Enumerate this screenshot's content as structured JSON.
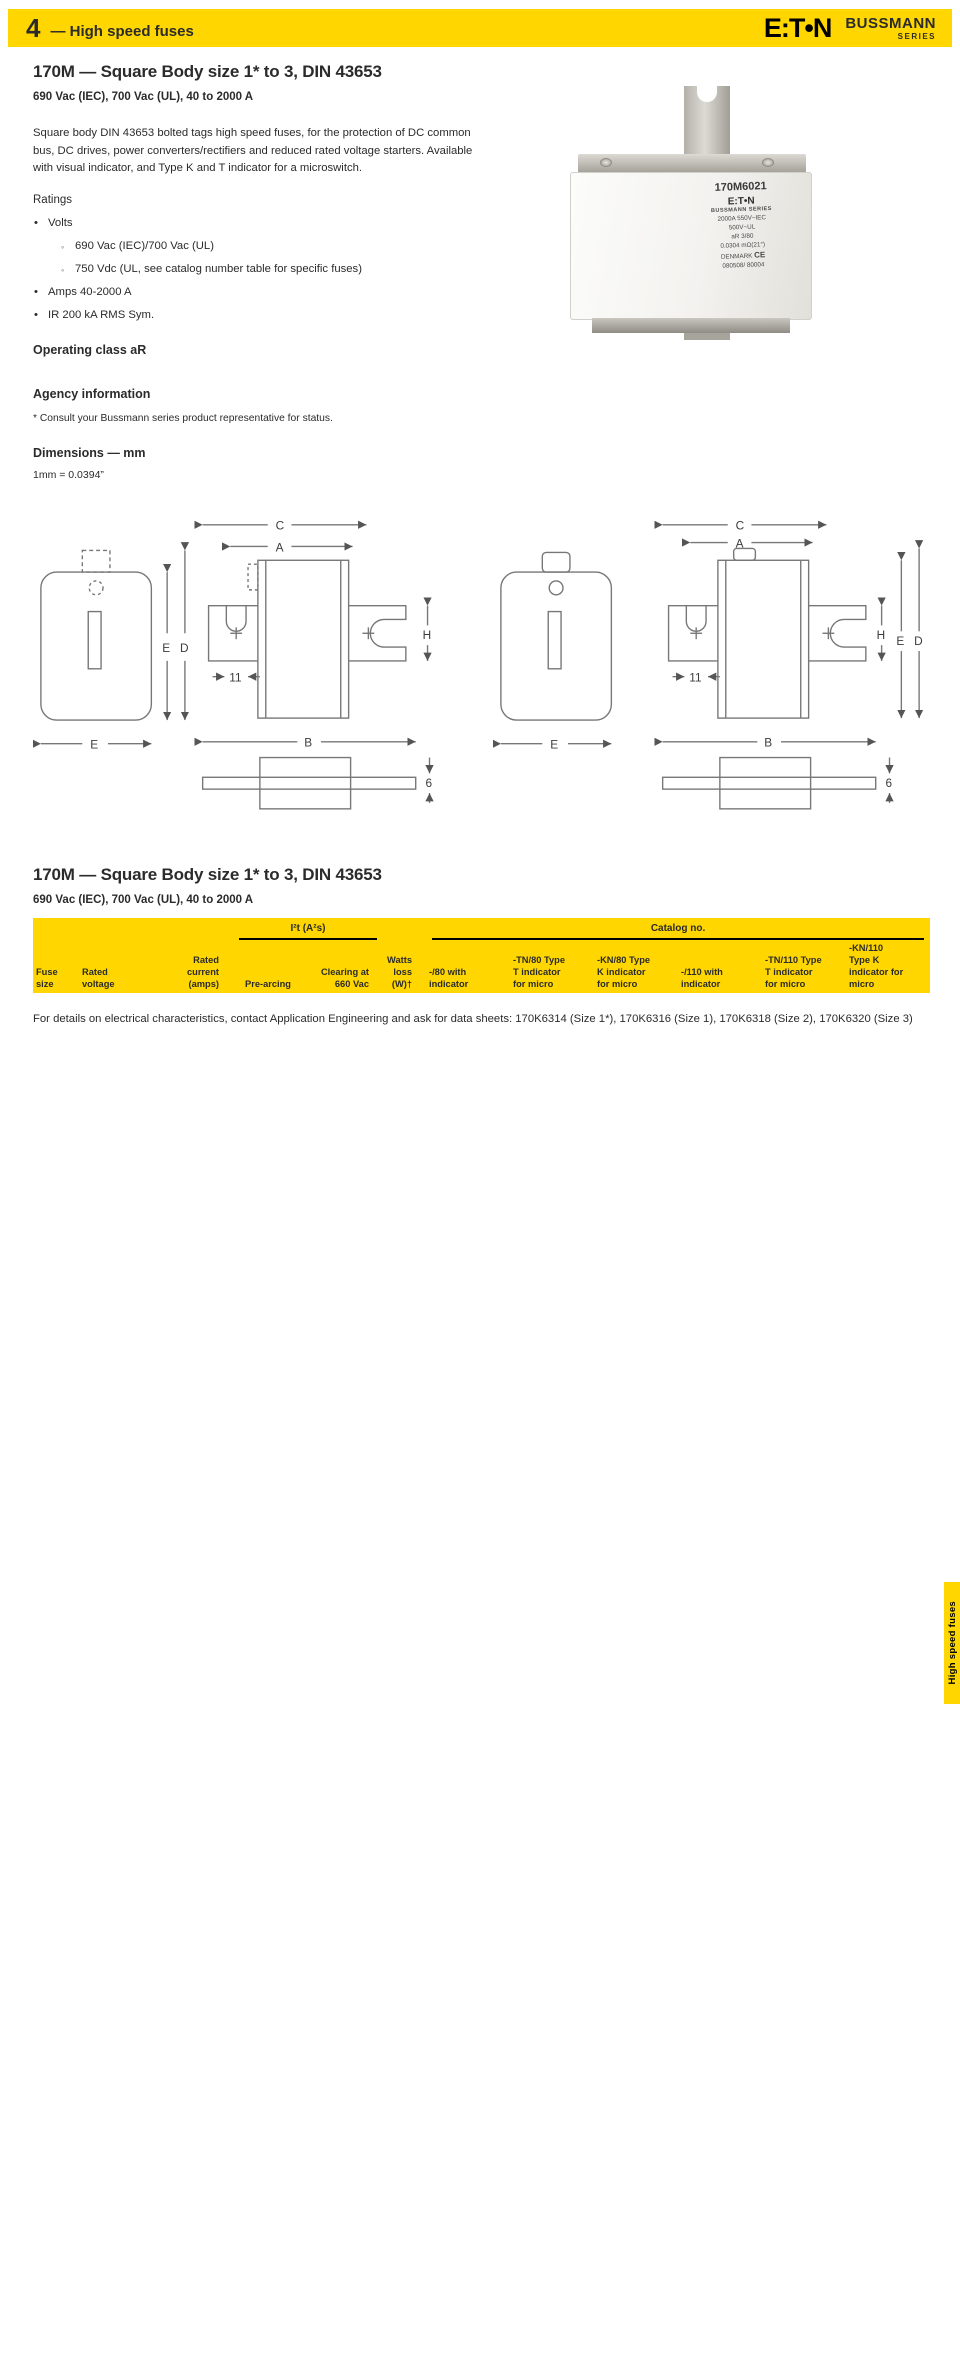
{
  "header": {
    "chapter": "4",
    "title": "High speed fuses",
    "logo_text": "E:T•N",
    "brand": "BUSSMANN",
    "brand_sub": "SERIES"
  },
  "section1": {
    "title": "170M — Square Body size 1* to 3, DIN 43653",
    "subtitle": "690 Vac (IEC), 700 Vac (UL), 40 to 2000 A",
    "description": "Square body DIN 43653 bolted tags high speed fuses, for the protection of DC common bus, DC drives, power converters/rectifiers and reduced rated voltage starters. Available with visual indicator, and Type K and T indicator for a microswitch.",
    "ratings_label": "Ratings",
    "ratings_items": [
      {
        "text": "Volts",
        "sub": [
          "690 Vac (IEC)/700 Vac (UL)",
          "750 Vdc (UL, see catalog number table for specific fuses)"
        ]
      },
      {
        "text": "Amps 40-2000 A"
      },
      {
        "text": "IR 200 kA RMS Sym."
      }
    ],
    "operating_class": "Operating class aR",
    "agency_title": "Agency information",
    "agency_items": [
      "Designed and tested to IEC 60269 Part 4",
      "UL Recognized, JFHR2*, E125085",
      "CSA Class 53787, File 1422-30*",
      "CCC except where noted",
      "CE"
    ],
    "agency_footnote": "*  Consult your Bussmann series product representative for status.",
    "dimensions_title": "Dimensions — mm",
    "dimensions_note": "1mm = 0.0394”"
  },
  "photo": {
    "part_number": "170M6021",
    "brand": "E:T•N",
    "series": "BUSSMANN SERIES",
    "line1": "2000A  550V~IEC",
    "line2": "500V~UL",
    "line3": "aR    3/80",
    "line4": "0.0304  mΩ(21°)",
    "line5": "DENMARK",
    "ce": "CE",
    "line6": "080508/ 80004"
  },
  "diagrams": {
    "labels": {
      "C": "C",
      "A": "A",
      "B": "B",
      "D": "D",
      "E": "E",
      "H": "H",
      "n11": "11",
      "n6": "6"
    }
  },
  "dim_left": {
    "title": "Type -/80, -TN/80, -/110, -TN/110",
    "headers": [
      "Size",
      "A",
      "B",
      "B¹",
      "C",
      "C¹",
      "D²",
      "E",
      "H"
    ],
    "rows": [
      [
        "1*",
        "50",
        "104",
        "134",
        "78",
        "108",
        "58",
        "45",
        "22"
      ],
      [
        "1",
        "50",
        "108",
        "138",
        "78",
        "108",
        "66",
        "53",
        "25"
      ],
      [
        "2",
        "50",
        "108",
        "138",
        "78",
        "108",
        "75",
        "61",
        "25"
      ],
      [
        "3",
        "51",
        "109",
        "139",
        "78",
        "108",
        "90",
        "76",
        "30"
      ]
    ],
    "footnotes": [
      "1  Valid for fuse Types -/110 and -TN/110.",
      "2  Valid for fuse Types -TN/80 and -TN/110."
    ]
  },
  "dim_right": {
    "title": "Type -KN/80, -KN/110",
    "headers": [
      "Size",
      "A",
      "B",
      "B³",
      "C",
      "C³",
      "D",
      "E",
      "H"
    ],
    "rows": [
      [
        "1*",
        "50",
        "104",
        "134",
        "78",
        "108",
        "59",
        "45",
        "22"
      ],
      [
        "1",
        "50",
        "108",
        "138",
        "78",
        "108",
        "69",
        "53",
        "25"
      ],
      [
        "2",
        "50",
        "108",
        "138",
        "78",
        "108",
        "77",
        "61",
        "25"
      ],
      [
        "3",
        "51",
        "109",
        "139",
        "78",
        "108",
        "92",
        "76",
        "30"
      ]
    ],
    "footnotes": [
      "3  Valid for fuse Type -KN/110."
    ]
  },
  "section2": {
    "title": "170M — Square Body size 1* to 3, DIN 43653",
    "subtitle": "690 Vac (IEC), 700 Vac (UL), 40 to 2000 A"
  },
  "catalog": {
    "group_i2t": "I²t (A²s)",
    "group_catalog": "Catalog no.",
    "col_headers": [
      "Fuse\nsize",
      "Rated\nvoltage",
      "Rated\ncurrent\n(amps)",
      "Pre-arcing",
      "Clearing at\n660 Vac",
      "Watts\nloss\n(W)†",
      "-/80 with\nindicator",
      "-TN/80 Type\nT indicator\nfor micro",
      "-KN/80 Type\nK indicator\nfor micro",
      "-/110 with\nindicator",
      "-TN/110 Type\nT indicator\nfor micro",
      "-KN/110\nType K\nindicator for\nmicro"
    ],
    "groups": [
      {
        "size": "1*",
        "voltages": [
          "690 Vac (IEC)",
          "700 Vac (UL)"
        ],
        "rows": [
          [
            "40",
            "40",
            "270",
            "9",
            "170M3008",
            "170M3058",
            "170M3108",
            "170M3158",
            "170M3208",
            "170M3258"
          ],
          [
            "50",
            "77",
            "515",
            "11",
            "170M3009",
            "170M3059",
            "170M3109",
            "170M3159",
            "170M3209",
            "170M3259"
          ],
          [
            "63",
            "115",
            "770",
            "14",
            "170M3010",
            "170M3060",
            "170M3110",
            "170M3160",
            "170M3210",
            "170M3260"
          ],
          [
            "80",
            "185",
            "1250",
            "18",
            "170M3011",
            "170M3061",
            "170M3111",
            "170M3161",
            "170M3211",
            "170M3261"
          ],
          [
            "100",
            "360",
            "2450",
            "21",
            "170M3012",
            "170M3062",
            "170M3112",
            "170M3162",
            "170M3212",
            "170M3262"
          ],
          [
            "125",
            "550",
            "3700",
            "26",
            "170M3013",
            "170M3063",
            "170M3113",
            "170M3163",
            "170M3213",
            "170M3263"
          ],
          [
            "160",
            "1100",
            "7500",
            "30",
            "170M3014",
            "170M3064",
            "170M3114",
            "170M3164",
            "170M3214",
            "170M3264"
          ],
          [
            "200",
            "2200",
            "15,000",
            "35",
            "170M3015",
            "170M3065",
            "170M3115",
            "170M3165",
            "170M3215",
            "170M3265"
          ],
          [
            "250",
            "4200",
            "28,500",
            "40",
            "170M3016",
            "170M3066",
            "170M3116",
            "170M3166",
            "170M3216",
            "170M3266"
          ],
          [
            "315",
            "7000",
            "46,500",
            "50",
            "170M3017",
            "170M3067",
            "170M3117",
            "170M3167",
            "170M3217",
            "170M3267"
          ],
          [
            "350",
            "10,000",
            "68,500",
            "55",
            "170M3018",
            "170M3068",
            "170M3118",
            "170M3168",
            "170M3218",
            "170M3268"
          ],
          [
            "400",
            "15,000",
            "105,000",
            "60",
            "170M3019",
            "170M3069",
            "170M3119",
            "170M3169",
            "170M3219",
            "170M3269"
          ],
          [
            "450",
            "21,000",
            "140,000",
            "65",
            "170M3020",
            "170M3070",
            "170M3120",
            "170M3170",
            "170M3220",
            "170M3270"
          ],
          [
            "500",
            "27,000",
            "180,000",
            "70",
            "170M3021",
            "170M3071",
            "170M3121",
            "170M3171",
            "170M3221",
            "170M3271"
          ],
          [
            "550",
            "34,000",
            "230,000",
            "75",
            "170M3022",
            "170M3072",
            "170M3122",
            "170M3172",
            "170M3222",
            "170M3272"
          ],
          [
            "630",
            "48,500",
            "325,000",
            "80",
            "170M3023",
            "170M3073",
            "170M3123",
            "170M3173",
            "170M3223",
            "170M3273"
          ]
        ]
      },
      {
        "size": "1",
        "voltages": [
          "690 Vac (IEC)",
          "700 Vac (UL)"
        ],
        "rows": [
          [
            "200",
            "1650",
            "11,500",
            "45",
            "170M4008",
            "170M4058",
            "170M4108",
            "170M4158",
            "170M4208",
            "170M4258"
          ],
          [
            "250",
            "3100",
            "21,000",
            "55",
            "170M4009",
            "170M4059",
            "170M4109",
            "170M4159",
            "170M4209",
            "170M4259"
          ],
          [
            "315",
            "6200",
            "42,000",
            "58",
            "170M4010",
            "170M4060",
            "170M4110",
            "170M4160",
            "170M4210",
            "170M4260"
          ],
          [
            "350",
            "8500",
            "59,000",
            "60",
            "170M4011",
            "170M4061",
            "170M4111",
            "170M4161",
            "170M4211",
            "170M4261"
          ],
          [
            "400",
            "13,500",
            "91,500",
            "65",
            "170M4012",
            "170M4062",
            "170M4112",
            "170M4162",
            "170M4212",
            "170M4262"
          ],
          [
            "450",
            "17,000",
            "120,000",
            "70",
            "170M4013",
            "170M4063",
            "170M4113",
            "170M4163",
            "170M4213",
            "170M4263"
          ],
          [
            "500",
            "25,000",
            "170,000",
            "72",
            "170M4014",
            "170M4064",
            "170M4114",
            "170M4164",
            "170M4214",
            "170M4264"
          ],
          [
            "550",
            "34,000",
            "230,000",
            "75",
            "170M4015",
            "170M4065",
            "170M4115",
            "170M4165",
            "170M4215",
            "170M4265"
          ],
          [
            "630",
            "52,000",
            "350,000",
            "80",
            "170M4016",
            "170M4066",
            "170M4116",
            "170M4166",
            "170M4216",
            "170M4266"
          ],
          [
            "700",
            "69,500",
            "465,000",
            "85",
            "170M4017",
            "170M4067",
            "170M4117",
            "170M4167",
            "170M4217",
            "170M4267"
          ],
          [
            "800",
            "105,000",
            "725,000",
            "95",
            "170M4018",
            "170M4068",
            "170M4118",
            "170M4168",
            "170M4218",
            "170M4268"
          ],
          [
            "900²",
            "155,000",
            "850,000²",
            "100",
            "170M4019¹",
            "170M4069¹",
            "170M4119¹",
            "170M4169¹",
            "170M4219¹",
            "170M4269¹"
          ]
        ]
      },
      {
        "size": "2",
        "voltages": [
          "690 Vac (IEC)",
          "700 Vac (UL)"
        ],
        "rows": [
          [
            "400",
            "11,000",
            "74,000",
            "65",
            "170M5008",
            "170M5058",
            "170M5108",
            "170M5158",
            "170M5208",
            "170M5258"
          ],
          [
            "450",
            "15,500",
            "105,000",
            "70",
            "170M5009",
            "170M5059",
            "170M5109",
            "170M5159",
            "170M5209",
            "170M5259"
          ],
          [
            "500",
            "21,500",
            "145,000",
            "75",
            "170M5010",
            "170M5060",
            "170M5110",
            "170M5160",
            "170M5210",
            "170M5260"
          ],
          [
            "550",
            "28,000",
            "190,000",
            "80",
            "170M5011",
            "170M5061",
            "170M5111",
            "170M5161",
            "170M5211",
            "170M5261"
          ],
          [
            "630",
            "41,000",
            "275,000",
            "90",
            "170M5012",
            "170M5062",
            "170M5112",
            "170M5162",
            "170M5212",
            "170M5262"
          ],
          [
            "700",
            "60,500",
            "405,000",
            "95",
            "170M5013",
            "170M5063",
            "170M5113",
            "170M5163",
            "170M5213",
            "170M5263"
          ],
          [
            "800",
            "86,000",
            "575,000",
            "105",
            "170M5014",
            "170M5064",
            "170M5114",
            "170M5164",
            "170M5214",
            "170M5264"
          ],
          [
            "900",
            "125,000",
            "840,000",
            "110",
            "170M5015",
            "170M5065",
            "170M5115",
            "170M5165",
            "170M5215",
            "170M5265"
          ],
          [
            "1000",
            "180,000",
            "1,250,000",
            "115",
            "170M5016",
            "170M5066",
            "170M5116",
            "170M5166",
            "170M5216",
            "170M5266"
          ],
          [
            "1100³",
            "245,000",
            "1,600,000",
            "120",
            "170M5017",
            "170M5067",
            "170M5117",
            "170M5167",
            "170M5217",
            "170M5267"
          ],
          [
            "1250³",
            "365,000",
            "2,400,000",
            "130",
            "170M5018",
            "170M5068",
            "170M5118",
            "170M5168",
            "170M5218",
            "170M5268"
          ]
        ]
      },
      {
        "size": "3",
        "voltages": [
          "690 Vac (IEC)",
          "700 Vac (UL)"
        ],
        "rows": [
          [
            "500",
            "14,000",
            "95,000",
            "95",
            "170M6008",
            "170M6058",
            "170M6108",
            "170M6158",
            "170M6208",
            "170M6258"
          ],
          [
            "550",
            "19,500",
            "135,000",
            "100",
            "170M6009",
            "170M6059",
            "170M6109",
            "170M6159",
            "170M6209",
            "170M6259"
          ],
          [
            "630",
            "31,000",
            "210,000",
            "105",
            "170M6010",
            "170M6060",
            "170M6110",
            "170M6160",
            "170M6210",
            "170M6260"
          ],
          [
            "700",
            "44,500",
            "300,000",
            "110",
            "170M6011",
            "170M6061",
            "170M6111",
            "170M6161",
            "170M6211",
            "170M6261"
          ],
          [
            "800",
            "69,500",
            "465,000",
            "115",
            "170M6012",
            "170M6062",
            "170M6112",
            "170M6162",
            "170M6212",
            "170M6262"
          ],
          [
            "900",
            "100,000",
            "670,000",
            "120",
            "170M6013",
            "170M6063",
            "170M6113",
            "170M6163",
            "170M6213",
            "170M6263"
          ],
          [
            "1000",
            "140,000",
            "945,000",
            "125",
            "170M6014",
            "170M6064",
            "170M6114",
            "170M6164",
            "170M6214",
            "170M6264"
          ],
          [
            "1100",
            "190,000",
            "1,300,000",
            "130",
            "170M6015",
            "170M6065",
            "170M6115",
            "170M6165",
            "170M6215",
            "170M6265"
          ],
          [
            "1250",
            "290,000",
            "1,950,000",
            "140",
            "170M6016",
            "170M6066",
            "170M6116",
            "170M6166",
            "170M6216",
            "170M6266"
          ],
          [
            "1400",
            "370,000",
            "2,450,000",
            "155",
            "170M6017",
            "170M6067",
            "170M6117",
            "170M6167",
            "170M6217",
            "170M6267"
          ],
          [
            "1500",
            "460,000",
            "3,100,000",
            "160",
            "170M6018",
            "170M6068",
            "170M6118",
            "170M6168",
            "170M6218",
            "170M6268"
          ],
          [
            "1600",
            "580,000",
            "3,900,000",
            "160",
            "170M6019",
            "170M6069",
            "170M6119",
            "170M6169",
            "170M6219",
            "170M6269"
          ],
          [
            "1800⁴",
            "880,000",
            "5,250,000⁴",
            "165",
            "170M6020††",
            "170M6070††",
            "170M6120",
            "170M6170††",
            "170M6220††",
            "170M6270"
          ],
          [
            "2000⁵",
            "1,150,000",
            "6,350,000⁵",
            "175",
            "170M6021",
            "170M6071",
            "170M6121",
            "170M6171",
            "170M6221",
            "170M6271"
          ]
        ]
      }
    ],
    "side_tab": "High speed fuses"
  },
  "footnotes": [
    "†  Watts loss at rated current.",
    "††DC voltage rated at 750 Vdc, IR 130 kA DC, UL Recognized, File E12085.",
    "1  Not UL Recognized, 2 Rated voltage: 550 Vac IEC, 3 Rated voltage: 600 Vac IEC, 700 Vac UL, 4 Rated voltage: 600 Vac IEC, 500 Vac UL, 5 Rated voltage: 550 Vac IEC,\n    500 Vac UL."
  ],
  "closing": "For details on electrical characteristics, contact Application Engineering and ask for data sheets: 170K6314 (Size 1*), 170K6316 (Size 1), 170K6318 (Size 2), 170K6320 (Size 3)"
}
